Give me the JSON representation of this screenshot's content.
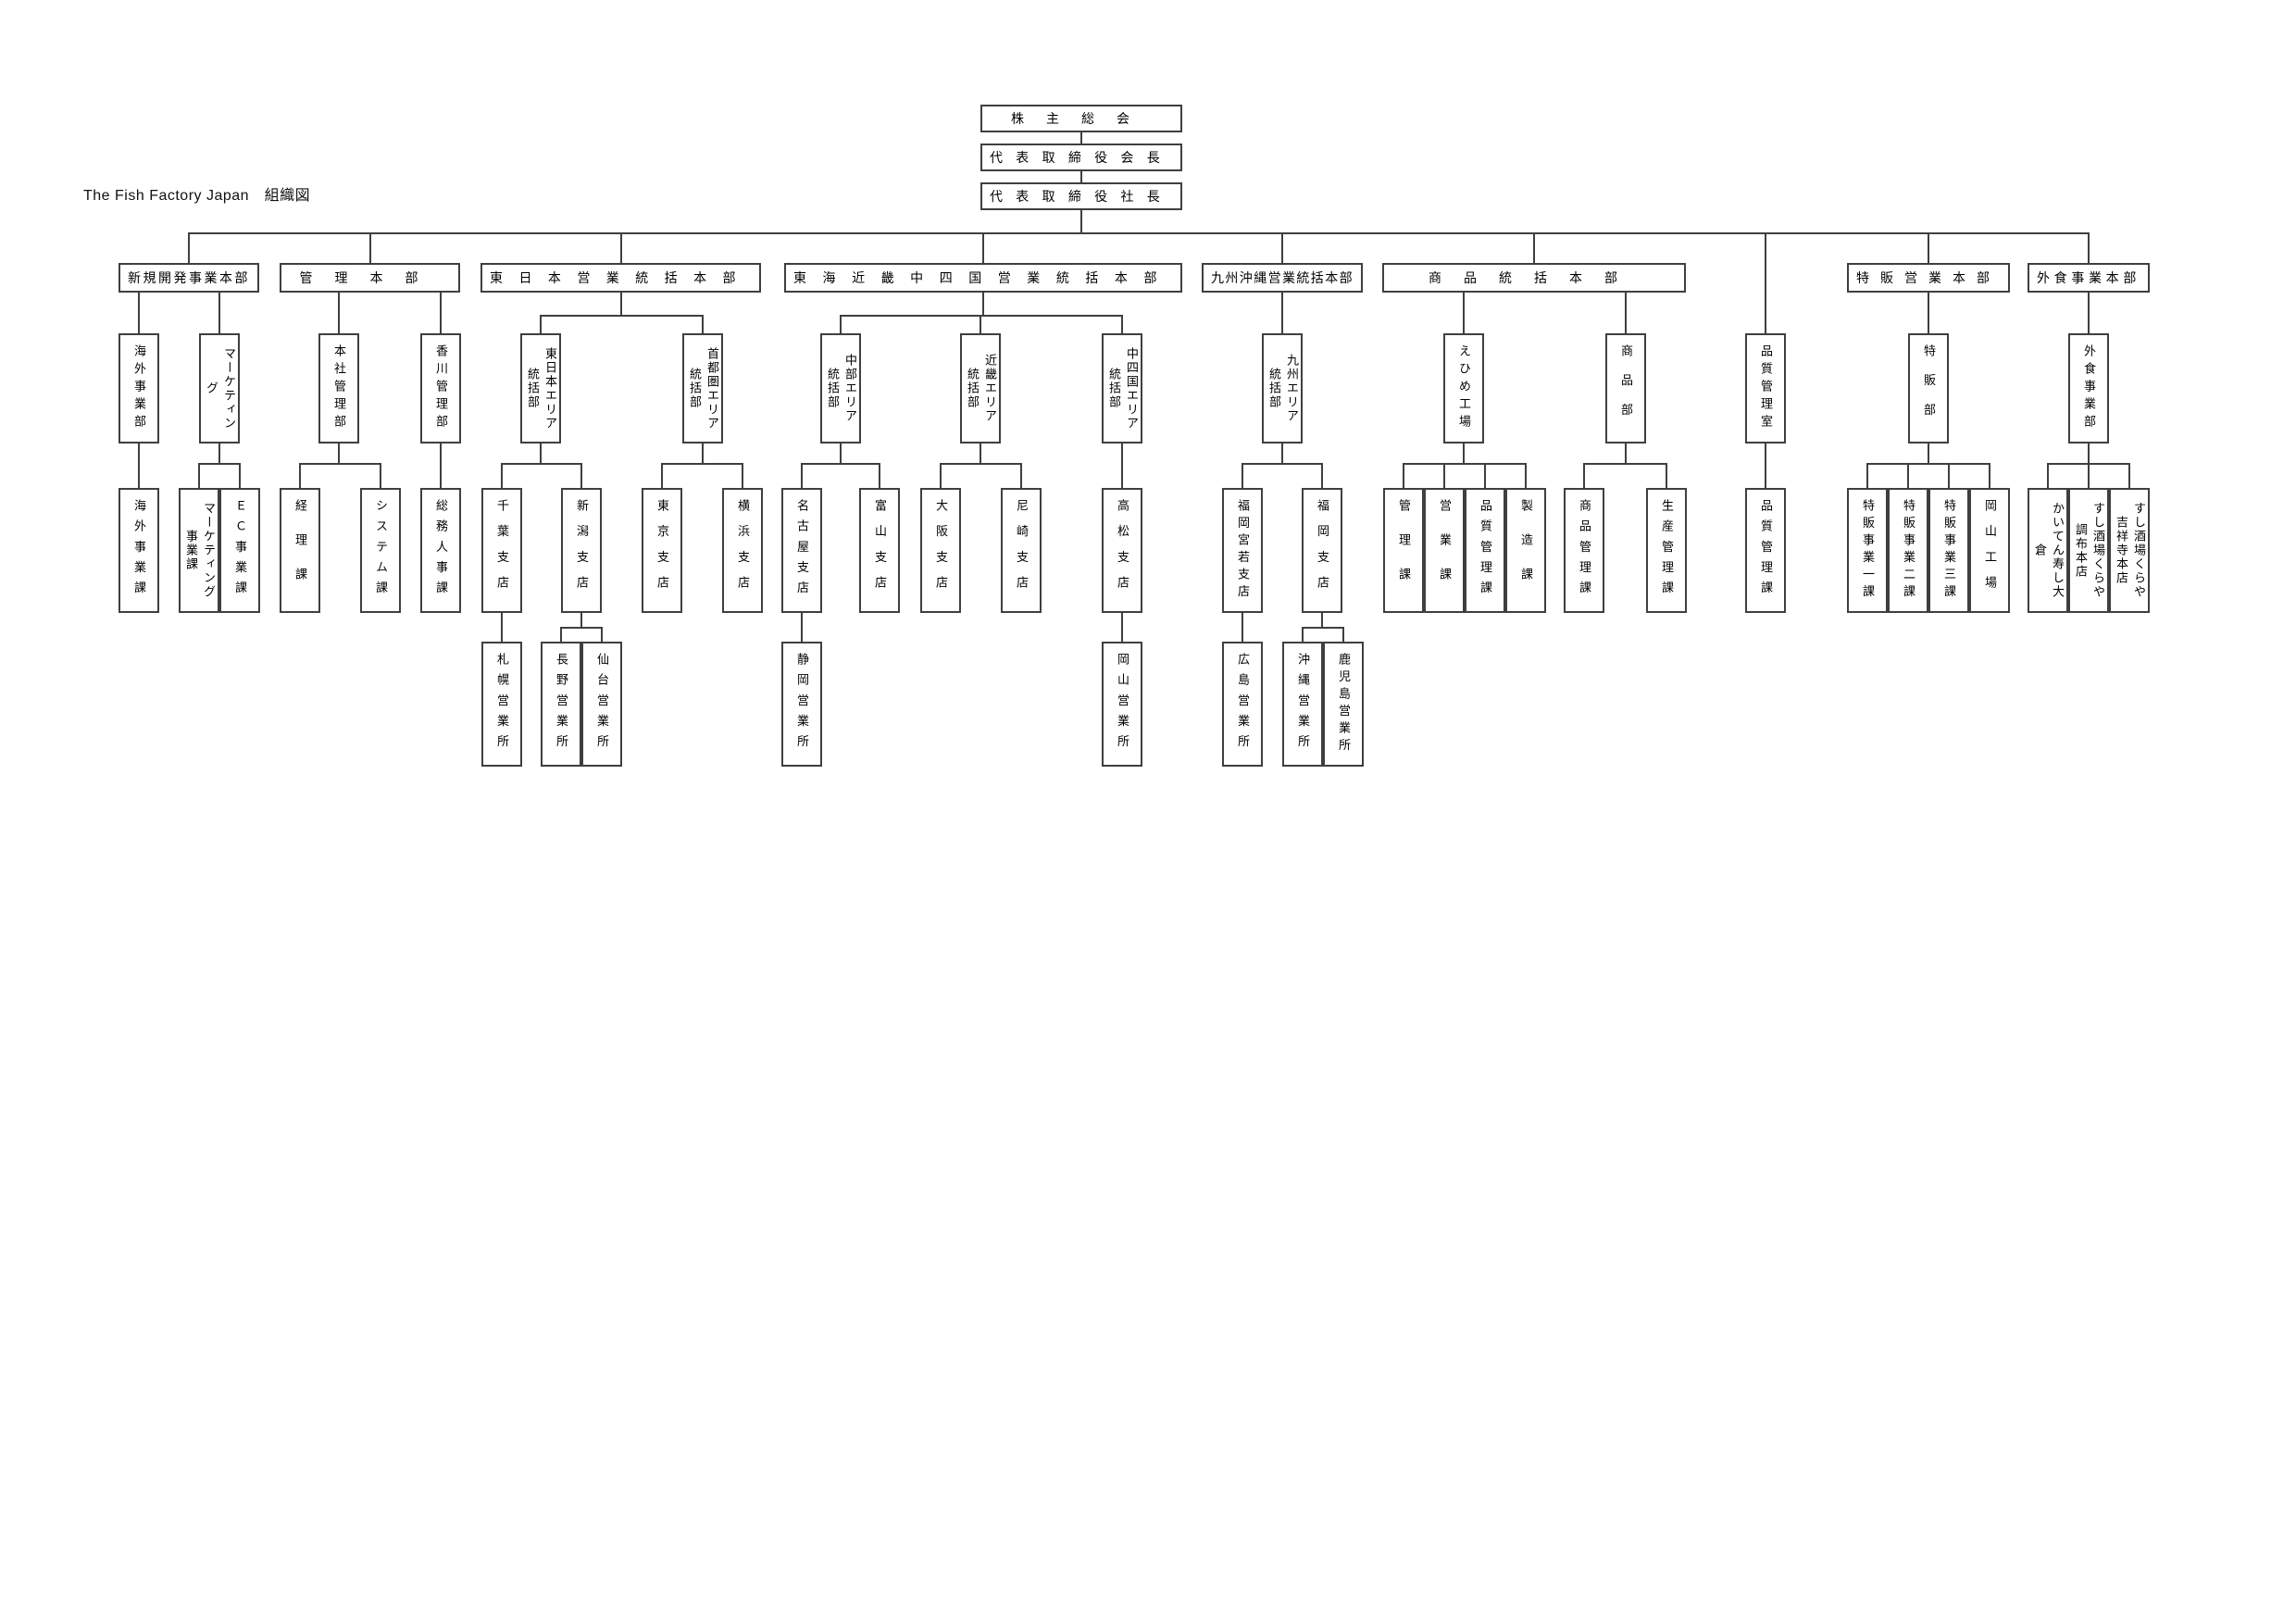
{
  "title": "The Fish Factory Japan　組織図",
  "colors": {
    "background": "#ffffff",
    "line": "#3f3f3f",
    "text": "#000000"
  },
  "chart": {
    "root_chain": [
      {
        "id": "sokai",
        "label": "株主総会"
      },
      {
        "id": "kaicho",
        "label": "代表取締役会長"
      },
      {
        "id": "shacho",
        "label": "代表取締役社長"
      }
    ],
    "divisions": [
      {
        "id": "shinki",
        "label": "新規開発事業本部",
        "children": [
          {
            "id": "kaigai_bu",
            "label": "海外事業部",
            "children": [
              {
                "id": "kaigai_ka",
                "label": "海外事業課"
              }
            ]
          },
          {
            "id": "marketing_bu",
            "label": "マーケティング\n事業部",
            "children": [
              {
                "id": "marketing_ka",
                "label": "マーケティング\n事業課"
              },
              {
                "id": "ec_ka",
                "label": "ＥＣ事業課"
              }
            ]
          }
        ]
      },
      {
        "id": "kanri",
        "label": "管理本部",
        "children": [
          {
            "id": "honsha_kanri",
            "label": "本社管理部",
            "children": [
              {
                "id": "keiri_ka",
                "label": "経理課"
              },
              {
                "id": "system_ka",
                "label": "システム課"
              }
            ]
          },
          {
            "id": "kagawa_kanri",
            "label": "香川管理部",
            "children": [
              {
                "id": "somu_jinji_ka",
                "label": "総務人事課"
              }
            ]
          }
        ]
      },
      {
        "id": "higashinihon",
        "label": "東日本営業統括本部",
        "children": [
          {
            "id": "higashinihon_area",
            "label": "東日本エリア\n統括部",
            "children": [
              {
                "id": "chiba",
                "label": "千葉支店",
                "children": [
                  {
                    "id": "sapporo",
                    "label": "札幌営業所"
                  }
                ]
              },
              {
                "id": "niigata",
                "label": "新潟支店",
                "children": [
                  {
                    "id": "nagano",
                    "label": "長野営業所"
                  },
                  {
                    "id": "sendai",
                    "label": "仙台営業所"
                  }
                ]
              }
            ]
          },
          {
            "id": "shutoken_area",
            "label": "首都圏エリア\n統括部",
            "children": [
              {
                "id": "tokyo",
                "label": "東京支店"
              },
              {
                "id": "yokohama",
                "label": "横浜支店"
              }
            ]
          }
        ]
      },
      {
        "id": "tokai",
        "label": "東海近畿中四国営業統括本部",
        "children": [
          {
            "id": "chubu_area",
            "label": "中部エリア\n統括部",
            "children": [
              {
                "id": "nagoya",
                "label": "名古屋支店",
                "children": [
                  {
                    "id": "shizuoka",
                    "label": "静岡営業所"
                  }
                ]
              },
              {
                "id": "toyama",
                "label": "富山支店"
              }
            ]
          },
          {
            "id": "kinki_area",
            "label": "近畿エリア\n統括部",
            "children": [
              {
                "id": "osaka",
                "label": "大阪支店"
              },
              {
                "id": "amagasaki",
                "label": "尼崎支店"
              }
            ]
          },
          {
            "id": "chushikoku_area",
            "label": "中四国エリア\n統括部",
            "children": [
              {
                "id": "takamatsu",
                "label": "高松支店",
                "children": [
                  {
                    "id": "okayama_eigyosho",
                    "label": "岡山営業所"
                  }
                ]
              }
            ]
          }
        ]
      },
      {
        "id": "kyushu_okinawa",
        "label": "九州沖縄営業統括本部",
        "children": [
          {
            "id": "kyushu_area",
            "label": "九州エリア\n統括部",
            "children": [
              {
                "id": "fukuoka_miyawaka",
                "label": "福岡宮若支店",
                "children": [
                  {
                    "id": "hiroshima",
                    "label": "広島営業所"
                  }
                ]
              },
              {
                "id": "fukuoka",
                "label": "福岡支店",
                "children": [
                  {
                    "id": "okinawa",
                    "label": "沖縄営業所"
                  },
                  {
                    "id": "kagoshima",
                    "label": "鹿児島営業所"
                  }
                ]
              }
            ]
          }
        ]
      },
      {
        "id": "shohin_tokatsu",
        "label": "商品統括本部",
        "children": [
          {
            "id": "ehime",
            "label": "えひめ工場",
            "children": [
              {
                "id": "ehime_kanri_ka",
                "label": "管理課"
              },
              {
                "id": "ehime_eigyo_ka",
                "label": "営業課"
              },
              {
                "id": "ehime_hinshitsu_ka",
                "label": "品質管理課"
              },
              {
                "id": "seizo_ka",
                "label": "製造課"
              }
            ]
          },
          {
            "id": "shohin_bu",
            "label": "商品部",
            "children": [
              {
                "id": "shohin_kanri_ka",
                "label": "商品管理課"
              },
              {
                "id": "seisan_kanri_ka",
                "label": "生産管理課"
              }
            ]
          }
        ]
      },
      {
        "id": "hinshitsu_shitsu",
        "label": "品質管理室",
        "office": true,
        "children": [
          {
            "id": "hinshitsu_kanri_ka",
            "label": "品質管理課"
          }
        ]
      },
      {
        "id": "tokuhan_eigyo",
        "label": "特販営業本部",
        "children": [
          {
            "id": "tokuhan_bu",
            "label": "特販部",
            "children": [
              {
                "id": "tokuhan_1ka",
                "label": "特販事業一課"
              },
              {
                "id": "tokuhan_2ka",
                "label": "特販事業二課"
              },
              {
                "id": "tokuhan_3ka",
                "label": "特販事業三課"
              },
              {
                "id": "okayama_kojo",
                "label": "岡山工場"
              }
            ]
          }
        ]
      },
      {
        "id": "gaishoku",
        "label": "外食事業本部",
        "children": [
          {
            "id": "gaishoku_bu",
            "label": "外食事業部",
            "children": [
              {
                "id": "kaiten_omicho",
                "label": "かいてん寿し大倉\n近江町店"
              },
              {
                "id": "kuraya_chofu",
                "label": "すし酒場くらや\n調布本店"
              },
              {
                "id": "kuraya_kichijoji",
                "label": "すし酒場くらや\n吉祥寺本店"
              }
            ]
          }
        ]
      }
    ]
  }
}
